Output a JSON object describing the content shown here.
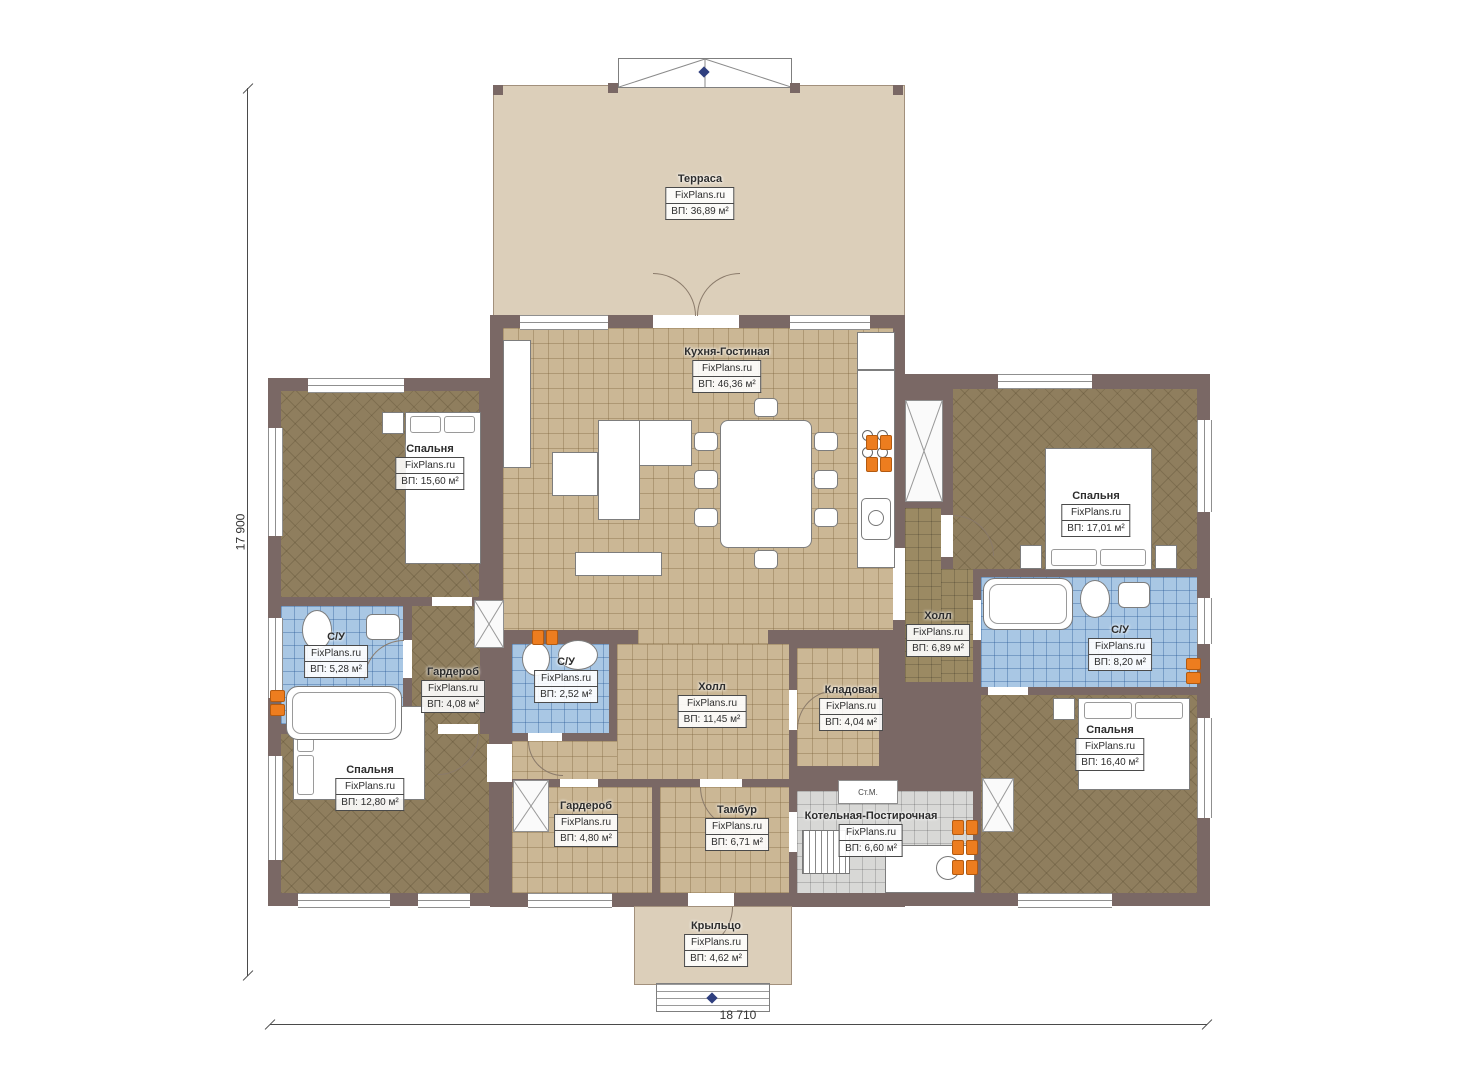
{
  "brand": "FixPlans.ru",
  "dimensions": {
    "height_label": "17 900",
    "width_label": "18 710"
  },
  "annotations": {
    "washer": "Ст.М."
  },
  "colors": {
    "wall": "#7a6865",
    "terrace_floor": "#dccfba",
    "tile_tan": "#cbb795",
    "carpet_brown": "#8f7e5e",
    "tile_blue": "#a9c7e4",
    "tile_gray": "#d8d8d6",
    "radiator_orange": "#ed7d1f"
  },
  "rooms": [
    {
      "id": "terrace",
      "name": "Терраса",
      "brand": "FixPlans.ru",
      "area": "ВП: 36,89 м²"
    },
    {
      "id": "kitchen_living",
      "name": "Кухня-Гостиная",
      "brand": "FixPlans.ru",
      "area": "ВП: 46,36 м²"
    },
    {
      "id": "bedroom_tl",
      "name": "Спальня",
      "brand": "FixPlans.ru",
      "area": "ВП: 15,60 м²"
    },
    {
      "id": "bathroom_left",
      "name": "С/У",
      "brand": "FixPlans.ru",
      "area": "ВП: 5,28 м²"
    },
    {
      "id": "wardrobe_left",
      "name": "Гардероб",
      "brand": "FixPlans.ru",
      "area": "ВП: 4,08 м²"
    },
    {
      "id": "bedroom_bl",
      "name": "Спальня",
      "brand": "FixPlans.ru",
      "area": "ВП: 12,80 м²"
    },
    {
      "id": "bathroom_center",
      "name": "С/У",
      "brand": "FixPlans.ru",
      "area": "ВП: 2,52 м²"
    },
    {
      "id": "hall_center",
      "name": "Холл",
      "brand": "FixPlans.ru",
      "area": "ВП: 11,45 м²"
    },
    {
      "id": "pantry",
      "name": "Кладовая",
      "brand": "FixPlans.ru",
      "area": "ВП: 4,04 м²"
    },
    {
      "id": "hall_right",
      "name": "Холл",
      "brand": "FixPlans.ru",
      "area": "ВП: 6,89 м²"
    },
    {
      "id": "bedroom_tr",
      "name": "Спальня",
      "brand": "FixPlans.ru",
      "area": "ВП: 17,01 м²"
    },
    {
      "id": "bathroom_right",
      "name": "С/У",
      "brand": "FixPlans.ru",
      "area": "ВП: 8,20 м²"
    },
    {
      "id": "bedroom_br",
      "name": "Спальня",
      "brand": "FixPlans.ru",
      "area": "ВП: 16,40 м²"
    },
    {
      "id": "wardrobe_bottom",
      "name": "Гардероб",
      "brand": "FixPlans.ru",
      "area": "ВП: 4,80 м²"
    },
    {
      "id": "tambour",
      "name": "Тамбур",
      "brand": "FixPlans.ru",
      "area": "ВП: 6,71 м²"
    },
    {
      "id": "boiler_laundry",
      "name": "Котельная-Постирочная",
      "brand": "FixPlans.ru",
      "area": "ВП: 6,60 м²"
    },
    {
      "id": "porch",
      "name": "Крыльцо",
      "brand": "FixPlans.ru",
      "area": "ВП: 4,62 м²"
    }
  ]
}
